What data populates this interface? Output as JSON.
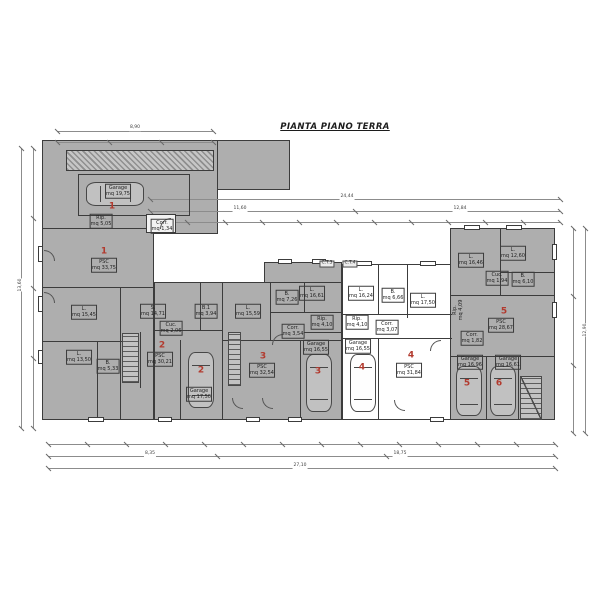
{
  "title": "PIANTA PIANO TERRA",
  "colors": {
    "background": "#ffffff",
    "building_fill_gray": "#aeaeae",
    "wall_line": "#3c3c3c",
    "unit_number_red": "#b23a2e",
    "dimension_line_gray": "#8c8c8c"
  },
  "plan": {
    "labels": [
      {
        "n": "label-garage-1",
        "x": 118,
        "y": 191,
        "t": [
          "Garage",
          "mq 19,75"
        ],
        "c": "room"
      },
      {
        "n": "unit-number-1-garage",
        "x": 112,
        "y": 207,
        "t": [
          "1"
        ],
        "c": "num"
      },
      {
        "n": "label-rip-1",
        "x": 101,
        "y": 221,
        "t": [
          "Rip.",
          "mq 5,05"
        ],
        "c": "room"
      },
      {
        "n": "label-corr-1",
        "x": 162,
        "y": 226,
        "t": [
          "Corr.",
          "mq 1,34"
        ],
        "c": "room"
      },
      {
        "n": "unit-number-1",
        "x": 104,
        "y": 252,
        "t": [
          "1"
        ],
        "c": "num"
      },
      {
        "n": "label-psc-1",
        "x": 104,
        "y": 265,
        "t": [
          "PSC",
          "mq 33,75"
        ],
        "c": "room"
      },
      {
        "n": "label-soggiorno-1",
        "x": 84,
        "y": 312,
        "t": [
          "L.",
          "mq 15,45"
        ],
        "c": "room"
      },
      {
        "n": "label-letto-1",
        "x": 79,
        "y": 357,
        "t": [
          "L.",
          "mq 13,50"
        ],
        "c": "room"
      },
      {
        "n": "label-bagno-1",
        "x": 108,
        "y": 366,
        "t": [
          "B.",
          "mq 5,33"
        ],
        "c": "room"
      },
      {
        "n": "label-stanza-2",
        "x": 153,
        "y": 311,
        "t": [
          "S.",
          "mq 14,71"
        ],
        "c": "room"
      },
      {
        "n": "label-bagno-2",
        "x": 206,
        "y": 311,
        "t": [
          "B.1",
          "mq 3,94"
        ],
        "c": "room"
      },
      {
        "n": "label-cucina-2",
        "x": 171,
        "y": 328,
        "t": [
          "Cuc.",
          "mq 2,06"
        ],
        "c": "room"
      },
      {
        "n": "unit-number-2",
        "x": 162,
        "y": 346,
        "t": [
          "2"
        ],
        "c": "num"
      },
      {
        "n": "label-psc-2",
        "x": 160,
        "y": 359,
        "t": [
          "PSC",
          "mq 30,21"
        ],
        "c": "room"
      },
      {
        "n": "unit-number-2-garage",
        "x": 201,
        "y": 371,
        "t": [
          "2"
        ],
        "c": "num"
      },
      {
        "n": "label-garage-2",
        "x": 199,
        "y": 394,
        "t": [
          "Garage",
          "mq 17,50"
        ],
        "c": "room"
      },
      {
        "n": "label-letto-3",
        "x": 248,
        "y": 311,
        "t": [
          "L.",
          "mq 15,59"
        ],
        "c": "room"
      },
      {
        "n": "label-bagno-3",
        "x": 287,
        "y": 297,
        "t": [
          "B.",
          "mq 7,26"
        ],
        "c": "room"
      },
      {
        "n": "label-letto2-3",
        "x": 312,
        "y": 293,
        "t": [
          "L.",
          "mq 16,61"
        ],
        "c": "room"
      },
      {
        "n": "label-rip-3",
        "x": 322,
        "y": 322,
        "t": [
          "Rip.",
          "mq 4,10"
        ],
        "c": "room"
      },
      {
        "n": "label-corr-3",
        "x": 293,
        "y": 331,
        "t": [
          "Corr.",
          "mq 3,54"
        ],
        "c": "room"
      },
      {
        "n": "unit-number-3",
        "x": 263,
        "y": 357,
        "t": [
          "3"
        ],
        "c": "num"
      },
      {
        "n": "label-psc-3",
        "x": 262,
        "y": 370,
        "t": [
          "PSC",
          "mq 32,54"
        ],
        "c": "room"
      },
      {
        "n": "label-garage-3",
        "x": 316,
        "y": 347,
        "t": [
          "Garage",
          "mq 16,55"
        ],
        "c": "room"
      },
      {
        "n": "unit-number-3-garage",
        "x": 318,
        "y": 372,
        "t": [
          "3"
        ],
        "c": "num"
      },
      {
        "n": "label-ct-3",
        "x": 327,
        "y": 264,
        "t": [
          "C.T.3"
        ],
        "c": "ct"
      },
      {
        "n": "label-ct-4",
        "x": 350,
        "y": 264,
        "t": [
          "C.T.4"
        ],
        "c": "ct"
      },
      {
        "n": "label-letto-4",
        "x": 361,
        "y": 293,
        "t": [
          "L.",
          "mq 16,24"
        ],
        "c": "room"
      },
      {
        "n": "label-bagno-4",
        "x": 393,
        "y": 295,
        "t": [
          "B.",
          "mq 6,66"
        ],
        "c": "room"
      },
      {
        "n": "label-letto2-4",
        "x": 423,
        "y": 300,
        "t": [
          "L.",
          "mq 17,50"
        ],
        "c": "room"
      },
      {
        "n": "label-rip-4",
        "x": 357,
        "y": 322,
        "t": [
          "Rip.",
          "mq 4,10"
        ],
        "c": "room"
      },
      {
        "n": "label-corr-4",
        "x": 387,
        "y": 327,
        "t": [
          "Corr.",
          "mq 3,07"
        ],
        "c": "room"
      },
      {
        "n": "unit-number-4",
        "x": 411,
        "y": 356,
        "t": [
          "4"
        ],
        "c": "num"
      },
      {
        "n": "label-psc-4",
        "x": 409,
        "y": 370,
        "t": [
          "PSC",
          "mq 31,84"
        ],
        "c": "room"
      },
      {
        "n": "label-garage-4",
        "x": 358,
        "y": 346,
        "t": [
          "Garage",
          "mq 16,55"
        ],
        "c": "room"
      },
      {
        "n": "unit-number-4-garage",
        "x": 362,
        "y": 368,
        "t": [
          "4"
        ],
        "c": "num"
      },
      {
        "n": "label-letto-5",
        "x": 471,
        "y": 260,
        "t": [
          "L.",
          "mq 16,46"
        ],
        "c": "room"
      },
      {
        "n": "label-letto2-5",
        "x": 513,
        "y": 253,
        "t": [
          "L.",
          "mq 12,60"
        ],
        "c": "room"
      },
      {
        "n": "label-bagno-5",
        "x": 523,
        "y": 279,
        "t": [
          "B.",
          "mq 6,10"
        ],
        "c": "room"
      },
      {
        "n": "label-cucina-5",
        "x": 497,
        "y": 278,
        "t": [
          "Cuc.",
          "mq 1,94"
        ],
        "c": "room"
      },
      {
        "n": "label-rip-5",
        "x": 458,
        "y": 310,
        "t": [
          "Rip.",
          "mq 4,09"
        ],
        "c": "roomv"
      },
      {
        "n": "unit-number-5",
        "x": 504,
        "y": 312,
        "t": [
          "5"
        ],
        "c": "num"
      },
      {
        "n": "label-psc-5",
        "x": 501,
        "y": 325,
        "t": [
          "PSC",
          "mq 28,67"
        ],
        "c": "room"
      },
      {
        "n": "label-corr-5",
        "x": 472,
        "y": 338,
        "t": [
          "Corr.",
          "mq 1,82"
        ],
        "c": "room"
      },
      {
        "n": "label-garage-5",
        "x": 470,
        "y": 362,
        "t": [
          "Garage",
          "mq 16,96"
        ],
        "c": "room"
      },
      {
        "n": "unit-number-5-garage",
        "x": 467,
        "y": 384,
        "t": [
          "5"
        ],
        "c": "num"
      },
      {
        "n": "label-garage-6",
        "x": 508,
        "y": 362,
        "t": [
          "Garage",
          "mq 16,61"
        ],
        "c": "room"
      },
      {
        "n": "unit-number-6-garage",
        "x": 499,
        "y": 384,
        "t": [
          "6"
        ],
        "c": "num"
      },
      {
        "n": "dim-garage-top-total",
        "x": 135,
        "y": 128,
        "t": [
          "8,90"
        ],
        "c": "dim"
      },
      {
        "n": "dim-top-total",
        "x": 347,
        "y": 197,
        "t": [
          "24,44"
        ],
        "c": "dim"
      },
      {
        "n": "dim-top-seg-a",
        "x": 240,
        "y": 209,
        "t": [
          "11,60"
        ],
        "c": "dim"
      },
      {
        "n": "dim-top-seg-b",
        "x": 460,
        "y": 209,
        "t": [
          "12,84"
        ],
        "c": "dim"
      },
      {
        "n": "dim-bottom-seg-a",
        "x": 150,
        "y": 454,
        "t": [
          "8,35"
        ],
        "c": "dim"
      },
      {
        "n": "dim-bottom-seg-b",
        "x": 400,
        "y": 454,
        "t": [
          "18,75"
        ],
        "c": "dim"
      },
      {
        "n": "dim-bottom-total",
        "x": 300,
        "y": 466,
        "t": [
          "27,10"
        ],
        "c": "dim"
      },
      {
        "n": "dim-left-total",
        "x": 21,
        "y": 285,
        "t": [
          "13,60"
        ],
        "c": "dimv"
      },
      {
        "n": "dim-right-total",
        "x": 586,
        "y": 330,
        "t": [
          "12,90"
        ],
        "c": "dimv"
      }
    ]
  }
}
